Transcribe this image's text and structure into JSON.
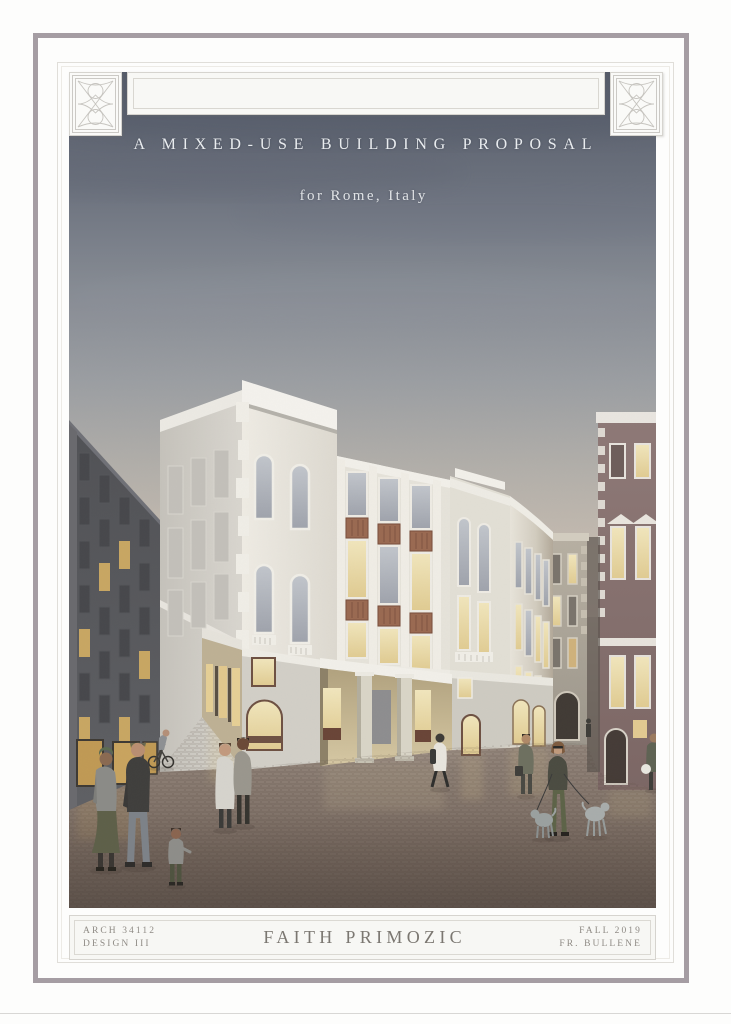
{
  "poster": {
    "title": "A MIXED-USE BUILDING PROPOSAL",
    "subtitle": "for Rome, Italy",
    "footer": {
      "course": "ARCH 34112",
      "studio": "DESIGN III",
      "author": "FAITH PRIMOZIC",
      "term": "FALL 2019",
      "instructor": "FR. BULLENE"
    }
  },
  "frame": {
    "mat_color": "#f8f8f5",
    "mauve_border_color": "#a59da3",
    "line_color": "#d6d4cf"
  },
  "illustration": {
    "description": "Watercolor dusk rendering of a four-story neoclassical mixed-use corner building in Rome with entrance loggia, lit shopfronts and pedestrians",
    "sky_top_color": "#555b69",
    "sky_horizon_color": "#cfc4b3",
    "street_color": "#8b7d73",
    "facade_color": "#e9e6de",
    "terracotta_panel_color": "#9a6a52",
    "lit_window_color": "#ead9a5",
    "elements": [
      "main-corner-building",
      "entrance-loggia",
      "curved-bay",
      "side-street",
      "dark-apartment-building",
      "ochre-building",
      "distant-white-building",
      "stone-tower",
      "maroon-palazzo",
      "pedestrians",
      "couple",
      "child",
      "cyclist",
      "dog-walker",
      "two-dogs"
    ]
  }
}
